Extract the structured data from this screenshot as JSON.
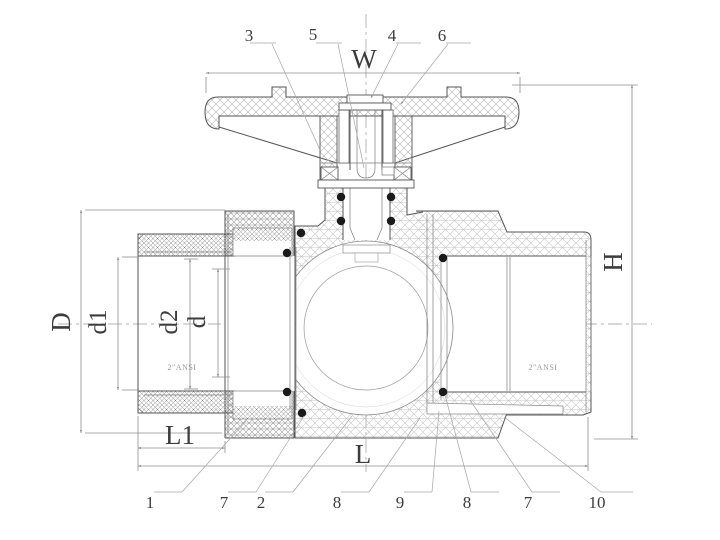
{
  "title": "Ball valve sectional technical drawing",
  "dimensions": {
    "width": "W",
    "height": "H",
    "length": "L",
    "length1": "L1",
    "outer_diameter": "D",
    "diameter1": "d1",
    "diameter2": "d2",
    "diameter": "d"
  },
  "ports": {
    "left_label": "2\"ANSI",
    "right_label": "2\"ANSI"
  },
  "callouts": {
    "top": [
      {
        "label": "3"
      },
      {
        "label": "5"
      },
      {
        "label": "4"
      },
      {
        "label": "6"
      }
    ],
    "bottom": [
      {
        "label": "1"
      },
      {
        "label": "7"
      },
      {
        "label": "2"
      },
      {
        "label": "8"
      },
      {
        "label": "9"
      },
      {
        "label": "8"
      },
      {
        "label": "7"
      },
      {
        "label": "10"
      }
    ]
  },
  "colors": {
    "line": "#555555",
    "dimension": "#8f8f8f",
    "hatch_light": "#c4c4c4",
    "hatch_dense": "#9a9a9a",
    "seal_dot": "#1a1a1a",
    "background": "#ffffff"
  }
}
